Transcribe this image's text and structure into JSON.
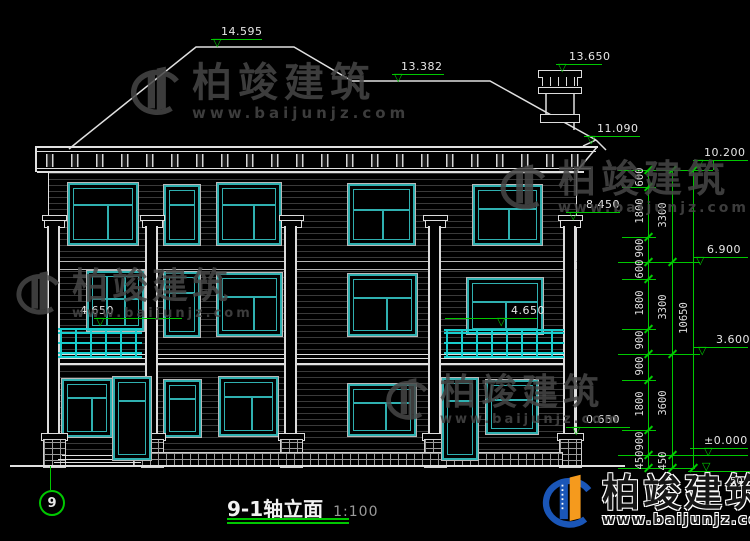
{
  "drawing": {
    "title": "9-1轴立面",
    "scale": "1:100",
    "axis_label": "9"
  },
  "watermark": {
    "name": "柏竣建筑",
    "url": "www.baijunjz.com"
  },
  "elevation_markers": {
    "main_ridge": "14.595",
    "secondary_ridge": "13.382",
    "chimney_top": "13.650",
    "right_eave": "11.090",
    "top_level": "10.200",
    "capital_level": "8.450",
    "third_floor_level": "6.900",
    "balcony_left": "4.650",
    "balcony_right": "4.650",
    "second_floor_level": "3.600",
    "base_top": "0.650",
    "ground_level": "±0.000",
    "below_ground_fragment": "50"
  },
  "dimension_chains": {
    "segments": [
      "600",
      "1800",
      "900",
      "600",
      "1800",
      "900",
      "900",
      "1800",
      "900",
      "450"
    ],
    "tiers": [
      "3300",
      "3300",
      "3600",
      "450"
    ],
    "total": "10650"
  },
  "colors": {
    "line": "#e0e0e0",
    "window_teal": "#2fb0b0",
    "railing_cyan": "#18cdcd",
    "dimension_green": "#00c800",
    "watermark_gray": "#474747",
    "logo_blue": "#1a56b8",
    "logo_orange": "#f59a1d"
  }
}
